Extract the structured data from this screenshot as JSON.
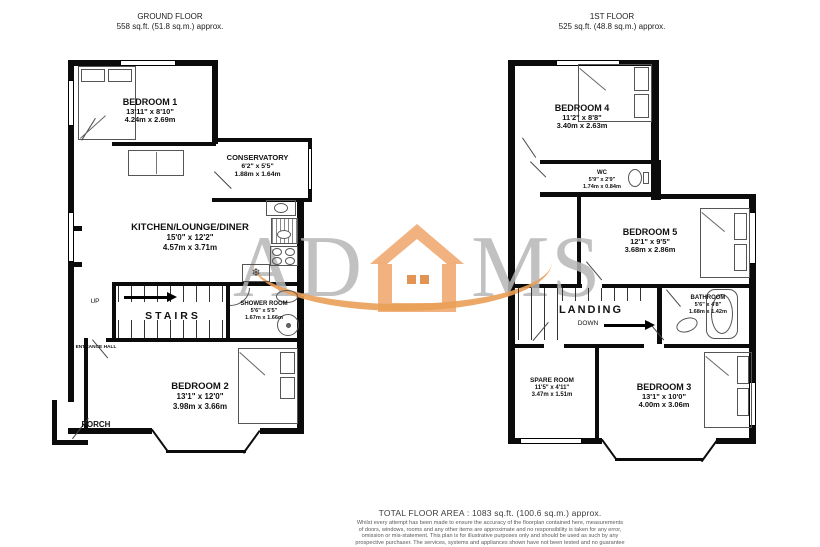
{
  "ground": {
    "title": "GROUND FLOOR",
    "area": "558 sq.ft. (51.8 sq.m.) approx.",
    "bedroom1": {
      "name": "BEDROOM 1",
      "imperial": "13'11\" x 8'10\"",
      "metric": "4.24m x 2.69m"
    },
    "conservatory": {
      "name": "CONSERVATORY",
      "imperial": "6'2\" x 5'5\"",
      "metric": "1.88m x 1.64m"
    },
    "kitchen": {
      "name": "KITCHEN/LOUNGE/DINER",
      "imperial": "15'0\" x 12'2\"",
      "metric": "4.57m x 3.71m"
    },
    "shower": {
      "name": "SHOWER ROOM",
      "imperial": "5'6\" x 5'5\"",
      "metric": "1.67m x 1.66m"
    },
    "bedroom2": {
      "name": "BEDROOM 2",
      "imperial": "13'1\" x 12'0\"",
      "metric": "3.98m x 3.66m"
    },
    "stairs": "STAIRS",
    "up": "UP",
    "entrance": "ENTRANCE HALL",
    "porch": "PORCH"
  },
  "first": {
    "title": "1ST FLOOR",
    "area": "525 sq.ft. (48.8 sq.m.) approx.",
    "bedroom4": {
      "name": "BEDROOM 4",
      "imperial": "11'2\" x 8'8\"",
      "metric": "3.40m x 2.63m"
    },
    "wc": {
      "name": "WC",
      "imperial": "5'9\" x 2'9\"",
      "metric": "1.74m x 0.84m"
    },
    "bedroom5": {
      "name": "BEDROOM 5",
      "imperial": "12'1\" x 9'5\"",
      "metric": "3.68m x 2.86m"
    },
    "bathroom": {
      "name": "BATHROOM",
      "imperial": "5'6\" x 4'8\"",
      "metric": "1.68m x 1.42m"
    },
    "spare": {
      "name": "SPARE ROOM",
      "imperial": "11'5\" x 4'11\"",
      "metric": "3.47m x 1.51m"
    },
    "bedroom3": {
      "name": "BEDROOM 3",
      "imperial": "13'1\" x 10'0\"",
      "metric": "4.00m x 3.06m"
    },
    "landing": "LANDING",
    "down": "DOWN"
  },
  "watermark": {
    "left": "AD",
    "right": "MS"
  },
  "icons": {
    "snowflake": "❄"
  },
  "colors": {
    "wall": "#0b0b0b",
    "watermark_text": "#b6b6b6",
    "logo_orange": "#f0ae78"
  },
  "footer": {
    "total": "TOTAL FLOOR AREA : 1083 sq.ft. (100.6 sq.m.) approx.",
    "disclaimer_lines": [
      "Whilst every attempt has been made to ensure the accuracy of the floorplan contained here, measurements",
      "of doors, windows, rooms and any other items are approximate and no responsibility is taken for any error,",
      "omission or mis-statement. This plan is for illustrative purposes only and should be used as such by any",
      "prospective purchaser. The services, systems and appliances shown have not been tested and no guarantee",
      "as to their operability or efficiency can be given."
    ],
    "credit": "Made with Metropix ©2023"
  }
}
